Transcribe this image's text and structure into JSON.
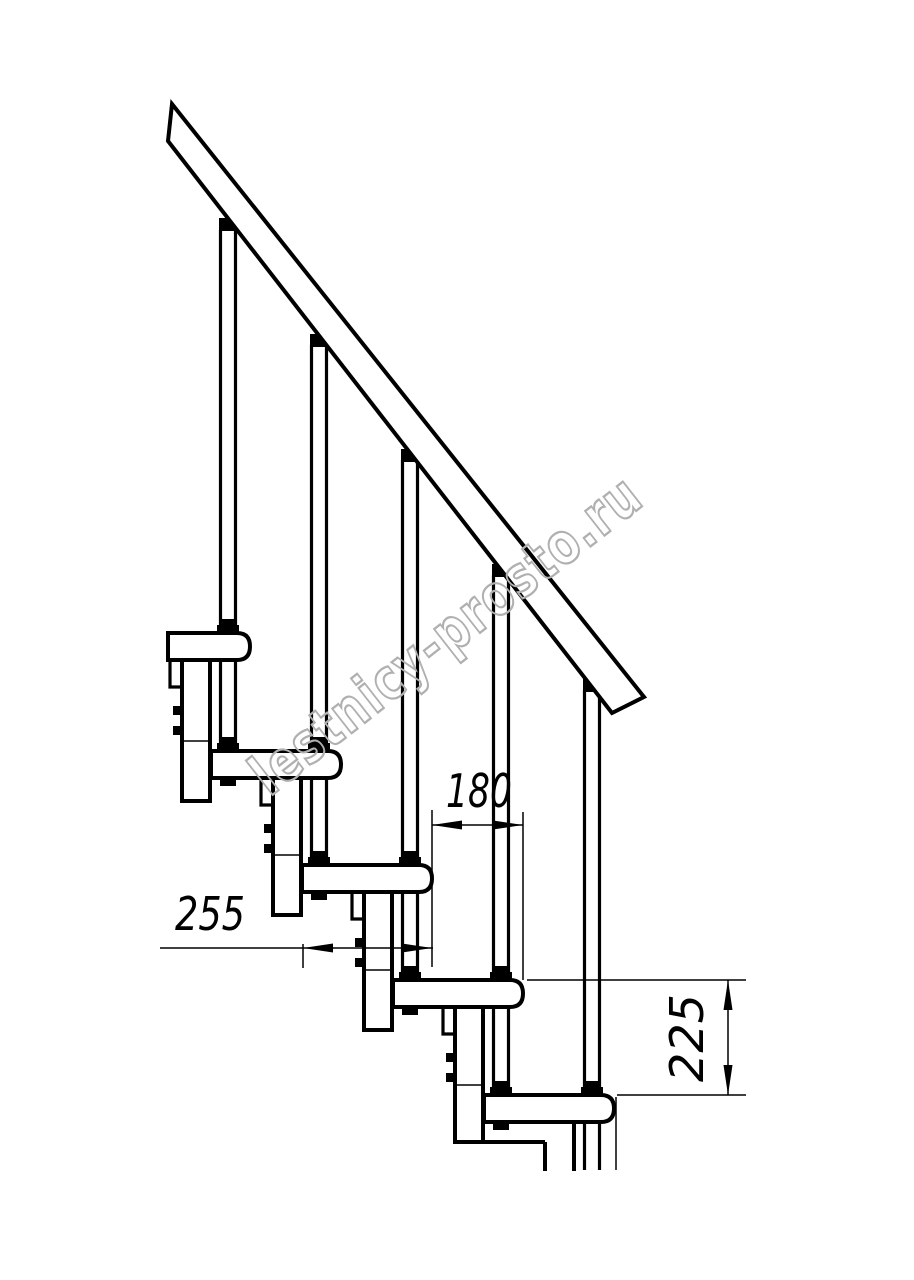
{
  "watermark": {
    "text": "lestnicy-prosto.ru"
  },
  "dimensions": {
    "step_run": "180",
    "tread_depth": "255",
    "step_rise": "225"
  },
  "colors": {
    "line": "#000000",
    "background": "#ffffff",
    "watermark": "#b0b0b0"
  }
}
